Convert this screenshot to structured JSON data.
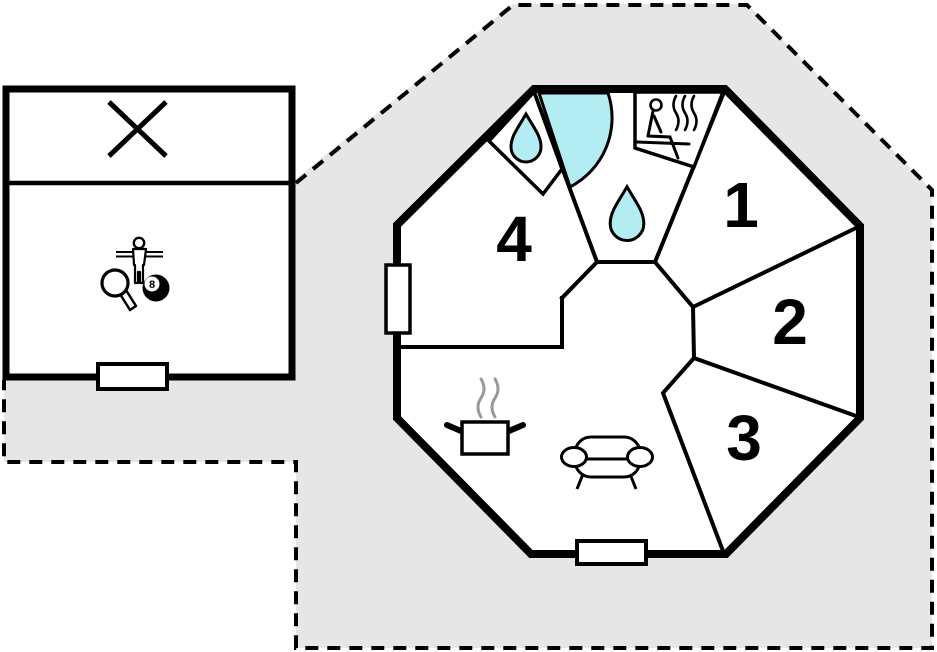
{
  "colors": {
    "plot_fill": "#e6e6e6",
    "water_fill": "#b3ecf2",
    "line": "#000000",
    "steam": "#999999"
  },
  "plot": {
    "shading": "gray",
    "boundary_style": "dashed"
  },
  "annex": {
    "terrace": {
      "icon": "crossed-box-icon"
    },
    "game_room": {
      "icons": [
        "foosball-player-icon",
        "table-tennis-paddle-icon",
        "billiard-8-ball-icon"
      ],
      "ball_label": "8"
    },
    "door": "door-opening"
  },
  "house": {
    "shape": "octagon",
    "rooms": [
      {
        "label": "1"
      },
      {
        "label": "2"
      },
      {
        "label": "3"
      },
      {
        "label": "4"
      }
    ],
    "wc": {
      "icon": "water-drop-icon"
    },
    "bathroom": {
      "icons": [
        "shower-basin-icon",
        "water-drop-icon"
      ]
    },
    "sauna": {
      "icons": [
        "sauna-person-icon",
        "heat-steam-icon"
      ]
    },
    "kitchen": {
      "icons": [
        "cooking-pot-icon",
        "heat-steam-icon"
      ]
    },
    "living": {
      "icon": "sofa-icon"
    },
    "window": "window-opening",
    "door": "door-opening"
  }
}
